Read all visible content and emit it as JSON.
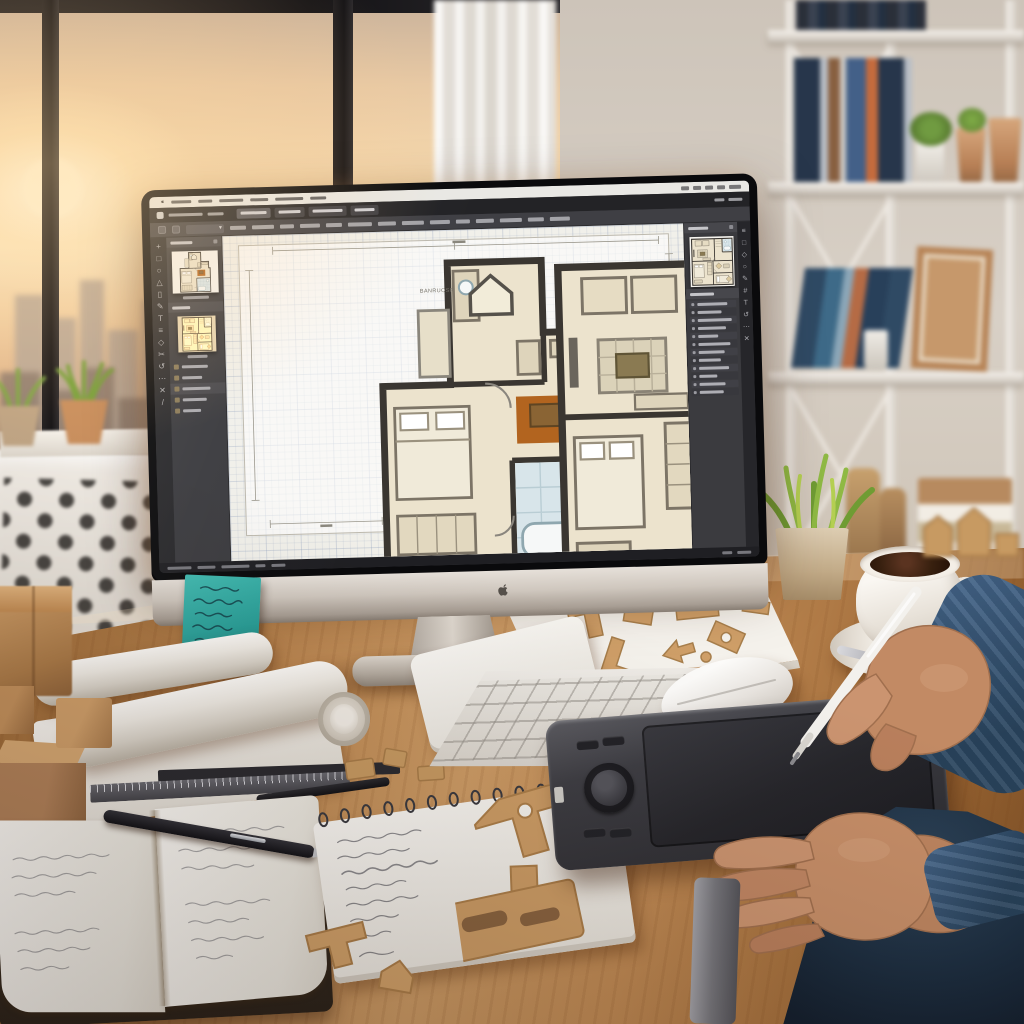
{
  "screen": {
    "canvas_label": "BANRUOSR",
    "description_colors": {
      "ui_dark": "#3b3b3f",
      "menubar_light": "#e9e8e4",
      "canvas_paper": "#f1f0ea",
      "plan_wall": "#3a3631",
      "plan_room": "#ece3cd",
      "plan_rug": "#b2641f",
      "plan_bath": "#d8e5ea",
      "accent_sticky_teal": "#2fa9a4",
      "desk_wood": "#bf8a54",
      "denim_sleeve": "#31506e",
      "skin": "#c28a64",
      "sunset_sky": "#f6d9ae"
    }
  },
  "ui": {
    "menubar": {
      "left": [
        20,
        14,
        24,
        18,
        28,
        16
      ],
      "right": [
        8,
        8,
        8,
        8,
        12
      ]
    },
    "titlebar": {
      "left": [
        34,
        16
      ],
      "tabs": [
        26,
        22,
        30,
        20
      ],
      "right": [
        10,
        14
      ]
    },
    "toolbar": {
      "chips": [
        16,
        22,
        14,
        20,
        16,
        24,
        18,
        22,
        20,
        14,
        18,
        22,
        16,
        20
      ]
    },
    "toolstrip": [
      {
        "n": "move-tool-icon",
        "g": "+"
      },
      {
        "n": "select-tool-icon",
        "g": "□"
      },
      {
        "n": "ellipse-tool-icon",
        "g": "○"
      },
      {
        "n": "triangle-tool-icon",
        "g": "△"
      },
      {
        "n": "wall-tool-icon",
        "g": "▯"
      },
      {
        "n": "pen-tool-icon",
        "g": "✎"
      },
      {
        "n": "text-tool-icon",
        "g": "T"
      },
      {
        "n": "layers-tool-icon",
        "g": "≡"
      },
      {
        "n": "polygon-tool-icon",
        "g": "◇"
      },
      {
        "n": "trim-tool-icon",
        "g": "✂"
      },
      {
        "n": "rotate-tool-icon",
        "g": "↺"
      },
      {
        "n": "more-tools-icon",
        "g": "⋯"
      },
      {
        "n": "erase-tool-icon",
        "g": "✕"
      },
      {
        "n": "measure-tool-icon",
        "g": "/"
      }
    ],
    "right_strip": [
      {
        "n": "layers-panel-icon",
        "g": "≡"
      },
      {
        "n": "pages-panel-icon",
        "g": "□"
      },
      {
        "n": "assets-panel-icon",
        "g": "◇"
      },
      {
        "n": "styles-panel-icon",
        "g": "○"
      },
      {
        "n": "annotate-panel-icon",
        "g": "✎"
      },
      {
        "n": "grid-panel-icon",
        "g": "#"
      },
      {
        "n": "text-panel-icon",
        "g": "T"
      },
      {
        "n": "history-panel-icon",
        "g": "↺"
      },
      {
        "n": "more-panel-icon",
        "g": "⋯"
      },
      {
        "n": "close-panel-icon",
        "g": "✕"
      }
    ],
    "left_list": [
      {
        "w": 26
      },
      {
        "w": 20
      },
      {
        "w": 28,
        "hdr": 1
      },
      {
        "w": 24
      },
      {
        "w": 18
      }
    ],
    "layer_rows": [
      30,
      24,
      34,
      28,
      20,
      32,
      26,
      22,
      30,
      18,
      26,
      24
    ],
    "status": {
      "left": [
        24,
        18,
        28,
        10,
        14
      ],
      "right": [
        10,
        14
      ]
    }
  }
}
